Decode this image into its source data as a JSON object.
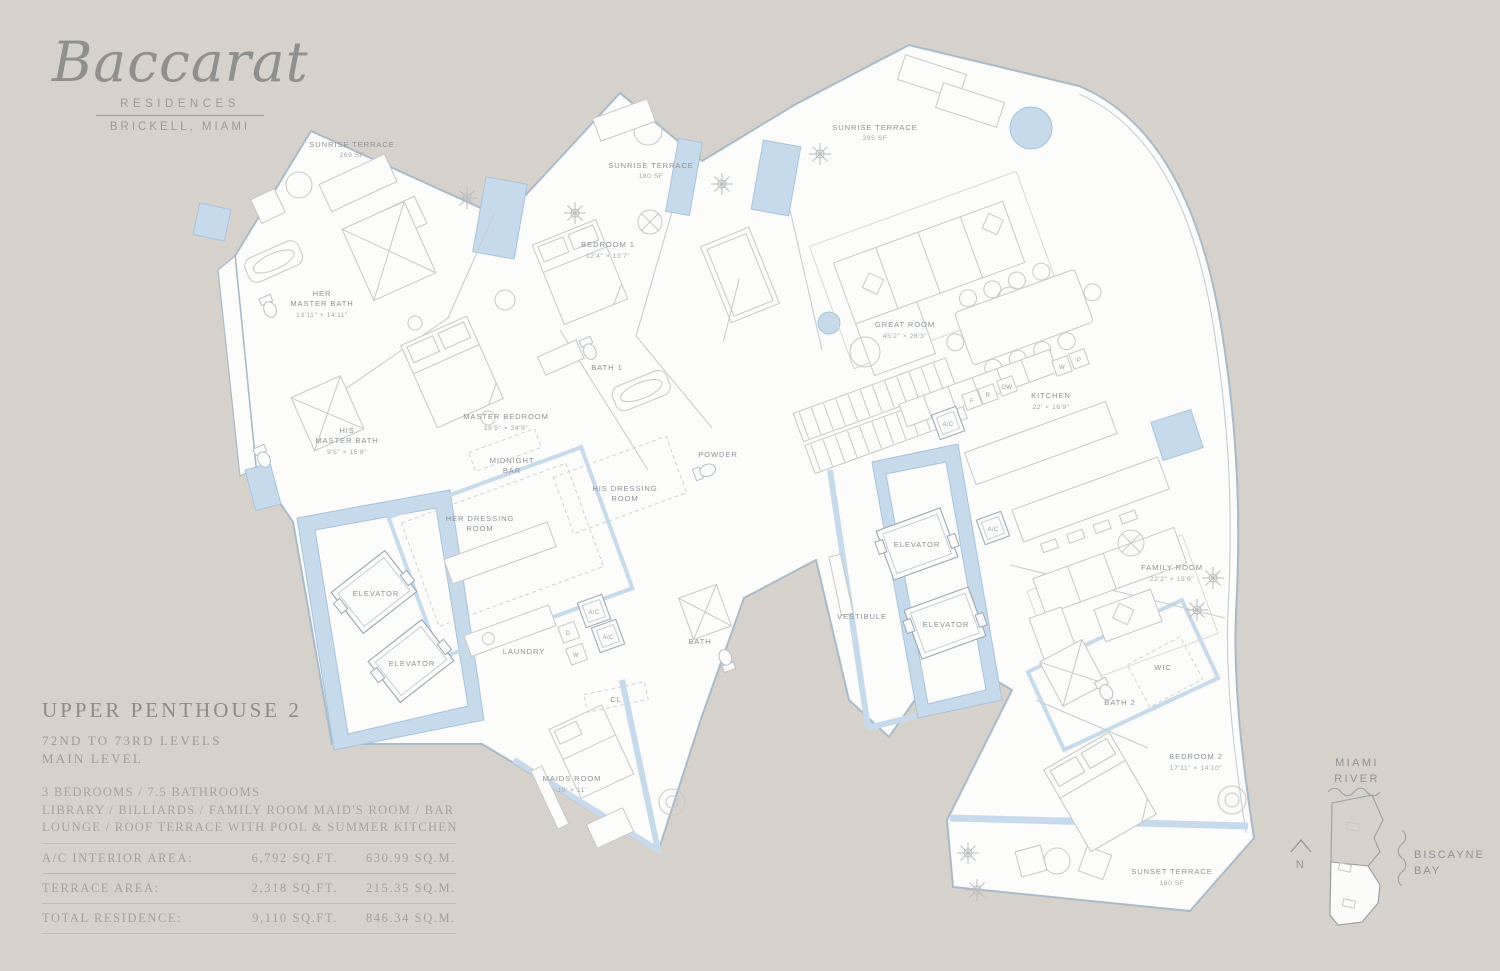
{
  "colors": {
    "background": "#d6d1ca",
    "plan_fill": "#fcfcfa",
    "wall_blue": "#c7daec",
    "wall_blue_stroke": "#a8c2dc",
    "label_gray": "#8d9297",
    "title_gray": "#8d8a87",
    "table_rule": "#c6b9b0"
  },
  "logo": {
    "brand": "Baccarat",
    "sub1": "RESIDENCES",
    "sub2": "BRICKELL, MIAMI"
  },
  "title_block": {
    "title": "UPPER PENTHOUSE 2",
    "level_line1": "72ND TO 73RD LEVELS",
    "level_line2": "MAIN LEVEL",
    "features": [
      "3 BEDROOMS / 7.5 BATHROOMS",
      "LIBRARY / BILLIARDS / FAMILY ROOM  MAID'S ROOM / BAR",
      "LOUNGE / ROOF TERRACE WITH POOL & SUMMER KITCHEN"
    ]
  },
  "areas": {
    "rows": [
      {
        "label": "A/C INTERIOR AREA:",
        "sqft": "6,792 SQ.FT.",
        "sqm": "630.99 SQ.M."
      },
      {
        "label": "TERRACE AREA:",
        "sqft": "2,318 SQ.FT.",
        "sqm": "215.35 SQ.M."
      },
      {
        "label": "TOTAL RESIDENCE:",
        "sqft": "9,110 SQ.FT.",
        "sqm": "846.34 SQ.M."
      }
    ]
  },
  "keymap": {
    "river_line1": "MIAMI",
    "river_line2": "RIVER",
    "bay_line1": "BISCAYNE",
    "bay_line2": "BAY",
    "north": "N"
  },
  "rooms": {
    "sunrise_terrace_a": {
      "name": "SUNRISE TERRACE",
      "size": "269 SF"
    },
    "sunrise_terrace_b": {
      "name": "SUNRISE TERRACE",
      "size": "180 SF"
    },
    "sunrise_terrace_c": {
      "name": "SUNRISE TERRACE",
      "size": "395 SF"
    },
    "her_master_bath": {
      "lines": [
        "HER",
        "MASTER BATH"
      ],
      "dims": "13'11\" × 14'11\""
    },
    "his_master_bath": {
      "lines": [
        "HIS",
        "MASTER BATH"
      ],
      "dims": "9'5\" × 15'8\""
    },
    "master_bedroom": {
      "name": "MASTER BEDROOM",
      "dims": "16'5\" × 24'9\""
    },
    "bedroom_1": {
      "name": "BEDROOM 1",
      "dims": "12'4\" × 13'7\""
    },
    "bath_1": {
      "name": "BATH 1"
    },
    "great_room": {
      "name": "GREAT ROOM",
      "dims": "45'2\" × 26'3\""
    },
    "kitchen": {
      "name": "KITCHEN",
      "dims": "22' × 16'9\""
    },
    "midnight_bar": {
      "lines": [
        "MIDNIGHT",
        "BAR"
      ]
    },
    "her_dressing_room": {
      "lines": [
        "HER DRESSING",
        "ROOM"
      ]
    },
    "his_dressing_room": {
      "lines": [
        "HIS DRESSING",
        "ROOM"
      ]
    },
    "powder": {
      "name": "POWDER"
    },
    "laundry": {
      "name": "LAUNDRY"
    },
    "bath": {
      "name": "BATH"
    },
    "elevator": {
      "name": "ELEVATOR"
    },
    "vestibule": {
      "name": "VESTIBULE"
    },
    "family_room": {
      "name": "FAMILY ROOM",
      "dims": "22'2\" × 15'6\""
    },
    "wic": {
      "name": "WIC"
    },
    "bath_2": {
      "name": "BATH 2"
    },
    "bedroom_2": {
      "name": "BEDROOM 2",
      "dims": "17'11\" × 14'10\""
    },
    "maids_room": {
      "name": "MAIDS ROOM",
      "dims": "10' × 11'"
    },
    "closet": {
      "name": "CL"
    },
    "sunset_terrace": {
      "name": "SUNSET TERRACE",
      "size": "180 SF"
    }
  },
  "fixtures": {
    "ac": "A/C",
    "d": "D",
    "w": "W",
    "dw": "DW",
    "f": "F",
    "r": "R",
    "p": "P"
  }
}
